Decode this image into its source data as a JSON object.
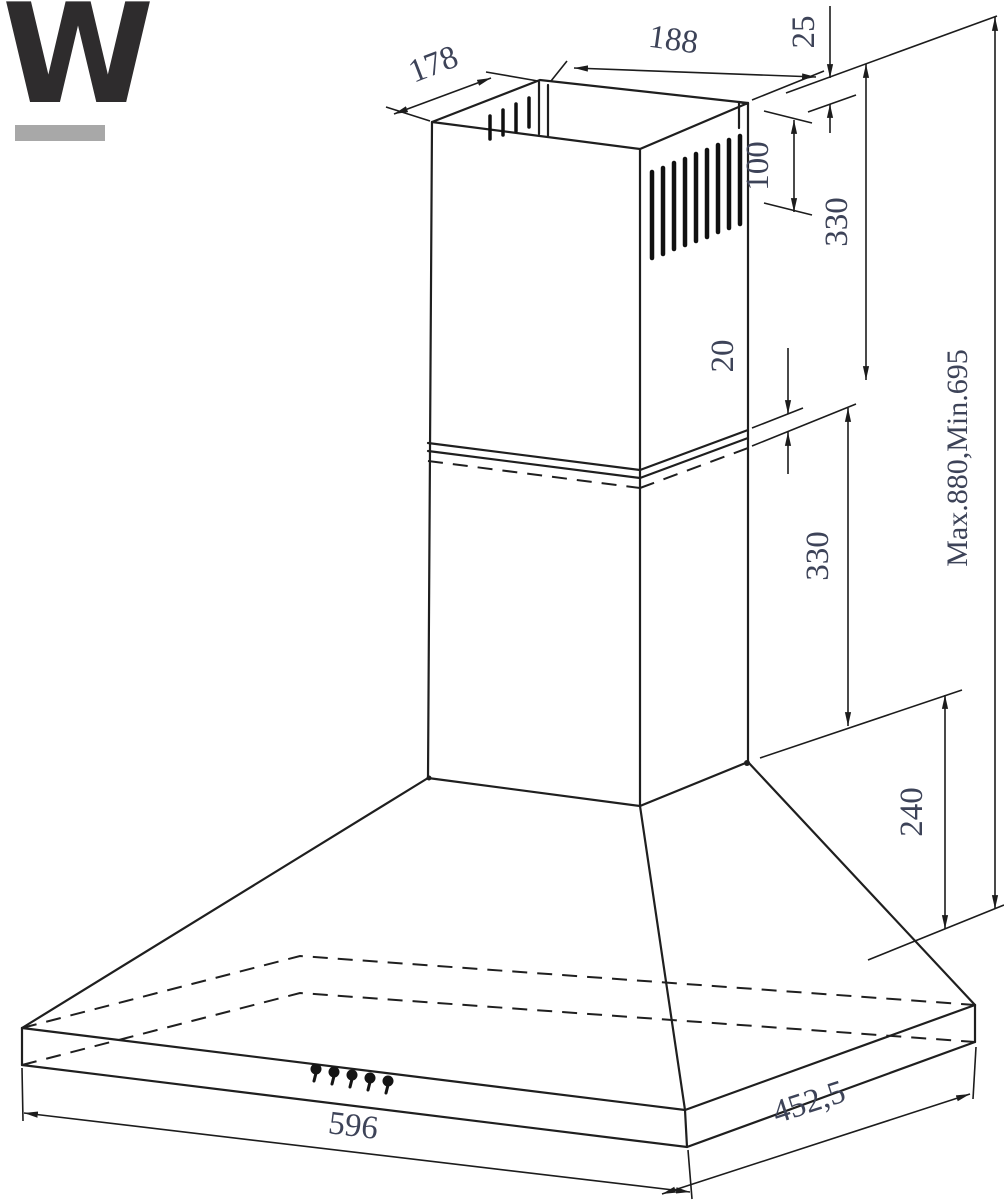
{
  "logo": {
    "letter": "W",
    "color": "#2e2c2d",
    "underline_color": "#a8a8a8"
  },
  "drawing": {
    "subject": "chimney cooker hood dimensional drawing",
    "line_color": "#1f1f1f",
    "dim_text_color": "#3d4358",
    "dimensions": {
      "duct_depth_top": {
        "label": "178"
      },
      "duct_width_top": {
        "label": "188"
      },
      "ceiling_gap": {
        "label": "25"
      },
      "vent_height": {
        "label": "100"
      },
      "upper_chimney_height": {
        "label": "330"
      },
      "telescopic_overlap": {
        "label": "20"
      },
      "lower_chimney_height": {
        "label": "330"
      },
      "total_height_range": {
        "label": "Max.880,Min.695"
      },
      "hood_body_height": {
        "label": "240"
      },
      "hood_width": {
        "label": "596"
      },
      "hood_depth": {
        "label": "452,5"
      }
    }
  }
}
